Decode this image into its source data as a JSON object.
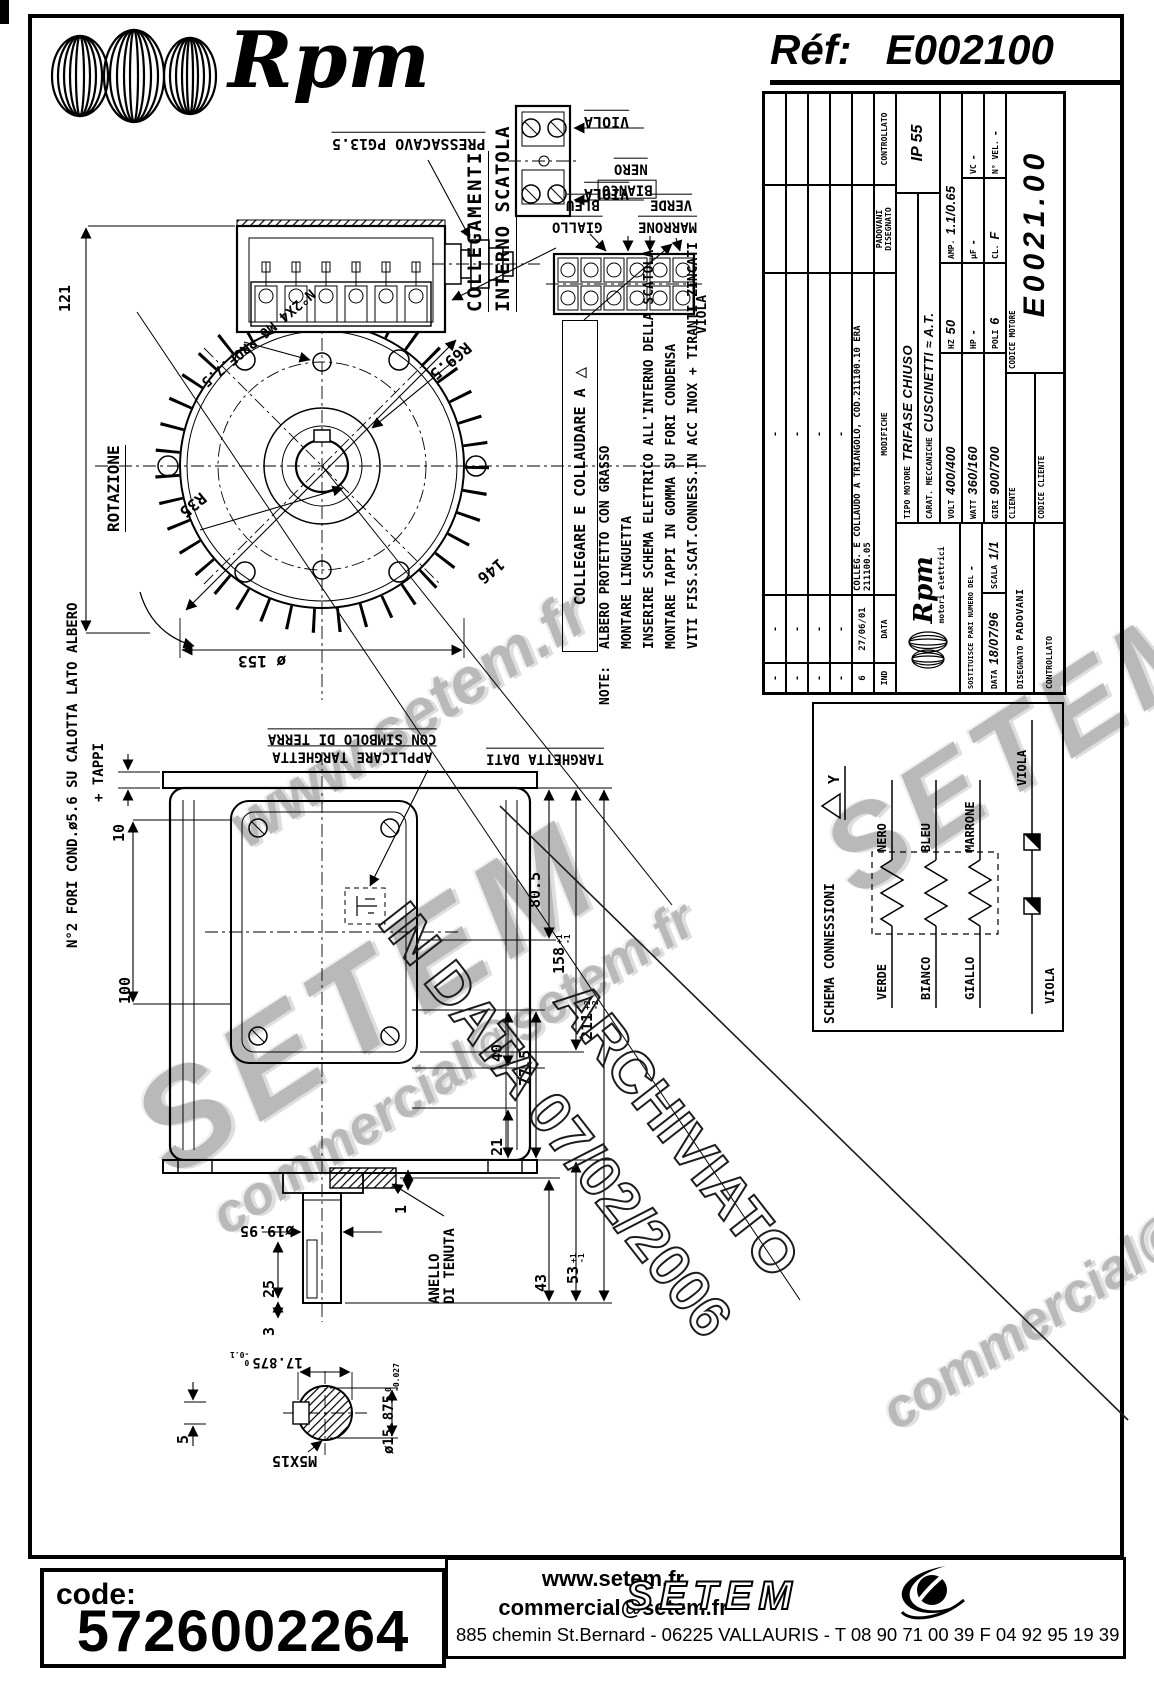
{
  "header": {
    "ref_label": "Réf:",
    "ref_value": "E002100",
    "brand": "Rpm"
  },
  "front": {
    "pressacavo": "PRESSACAVO PG13.5",
    "colleg1": "COLLEGAMENTI",
    "colleg2": "INTERNO SCATOLA",
    "d121": "121",
    "rotazione": "ROTAZIONE",
    "r35": "R35",
    "r69": "R69.5",
    "d146": "146",
    "d153": "ø 153",
    "n2x4": "N°2X4 M6 PROF.7.5"
  },
  "wires": {
    "viola": "VIOLA",
    "nero": "NERO",
    "bianco": "BIANCO",
    "bleu": "BLEU",
    "giallo": "GIALLO",
    "verde": "VERDE",
    "marrone": "MARRONE"
  },
  "collaudo": {
    "text": "COLLEGARE E COLLAUDARE A",
    "tri": "△"
  },
  "notes": {
    "label": "NOTE:",
    "l1": "ALBERO PROTETTO CON GRASSO",
    "l2": "MONTARE LINGUETTA",
    "l3": "INSERIRE SCHEMA ELETTRICO ALL'INTERNO DELLA SCATOLA",
    "l4": "MONTARE TAPPI IN GOMMA SU FORI CONDENSA",
    "l5": "VITI FISS.SCAT.CONNESS.IN ACC INOX + TIRANTI ZINCATI"
  },
  "side": {
    "fori": "N°2 FORI COND.ø5.6 SU CALOTTA LATO ALBERO",
    "tappi": "+ TAPPI",
    "d10": "10",
    "d100": "100",
    "d805": "80.5",
    "d158": "158",
    "d158p": "+1",
    "d158m": "-1",
    "d211": "211",
    "d211p": "+2",
    "d211m": "-2",
    "d40": "40",
    "d775": "77.5",
    "d21": "21",
    "d1": "1",
    "d1995": "ø19.95",
    "d25": "25",
    "d3": "3",
    "d43": "43",
    "d53": "53",
    "d53p": "+1",
    "d53m": "-1",
    "an1": "ANELLO",
    "an2": "DI TENUTA",
    "app1": "APPLICARE TARGHETTA",
    "app2": "CON SIMBOLO DI TERRA",
    "targ": "TARGHETTA DATI",
    "d17": "17.875",
    "d17p": "0",
    "d17m": "-0.1",
    "d15": "ø15.875",
    "d15p": "0",
    "d15m": "-0.027",
    "d5": "5",
    "m5": "M5X15"
  },
  "schema": {
    "title": "SCHEMA CONNESSIONI",
    "tri": "△",
    "star": "Y",
    "w1l": "VERDE",
    "w1r": "NERO",
    "w2l": "BIANCO",
    "w2r": "BLEU",
    "w3l": "GIALLO",
    "w3r": "MARRONE",
    "viola": "VIOLA"
  },
  "tb": {
    "dash": "-",
    "rev_ind": "6",
    "rev_data": "27/06/01",
    "rev_mod": "COLLEG. E COLLAUDO A TRIANGOLO, COD.211100.10 ERA 211100.05",
    "h_ind": "IND",
    "h_data": "DATA",
    "h_mod": "MODIFICHE",
    "h_dis_val": "PADOVANI",
    "h_dis": "DISEGNATO",
    "h_contr": "CONTROLLATO",
    "brand": "Rpm",
    "brand_sub": "motori elettrici",
    "sost_label": "SOSTITUISCE PARI NUMERO DEL",
    "sost_val": "-",
    "data_label": "DATA",
    "data_val": "18/07/96",
    "scala_label": "SCALA",
    "scala_val": "1/1",
    "dis_label": "DISEGNATO",
    "dis_val": "PADOVANI",
    "contr_label": "CONTROLLATO",
    "tipo_label": "TIPO MOTORE",
    "tipo_val": "TRIFASE CHIUSO",
    "carat_label": "CARAT. MECCANICHE",
    "carat_val": "CUSCINETTI ≈ A.T.",
    "ip": "IP 55",
    "volt_l": "VOLT",
    "volt": "400/400",
    "hz_l": "HZ",
    "hz": "50",
    "amp_l": "AMP.",
    "amp": "1.1/0.65",
    "watt_l": "WATT",
    "watt": "360/160",
    "hp_l": "HP",
    "hp": "-",
    "uf_l": "µF",
    "uf": "-",
    "vc_l": "VC",
    "vc": "-",
    "giri_l": "GIRI",
    "giri": "900/700",
    "poli_l": "POLI",
    "poli": "6",
    "cl_l": "CL.",
    "cl": "F",
    "nvel_l": "N° VEL.",
    "nvel": "-",
    "cliente": "CLIENTE",
    "cod_cliente": "CODICE CLIENTE",
    "cod_motore_l": "CODICE MOTORE",
    "cod_motore": "E0021.00"
  },
  "stamp": {
    "l1": "ARCHIVIATO",
    "l2": "IN DATA 07/02/2006"
  },
  "wm": {
    "w1": "www.setem.fr",
    "w2": "SETEM",
    "w3": "commercial@setem.fr"
  },
  "footer": {
    "code_label": "code:",
    "code": "5726002264",
    "site": "www.setem.fr",
    "email": "commercial@setem.fr",
    "address": "885 chemin St.Bernard  -  06225 VALLAURIS  -  T 08 90 71 00 39   F 04 92 95 19 39",
    "brand": "SETEM"
  }
}
